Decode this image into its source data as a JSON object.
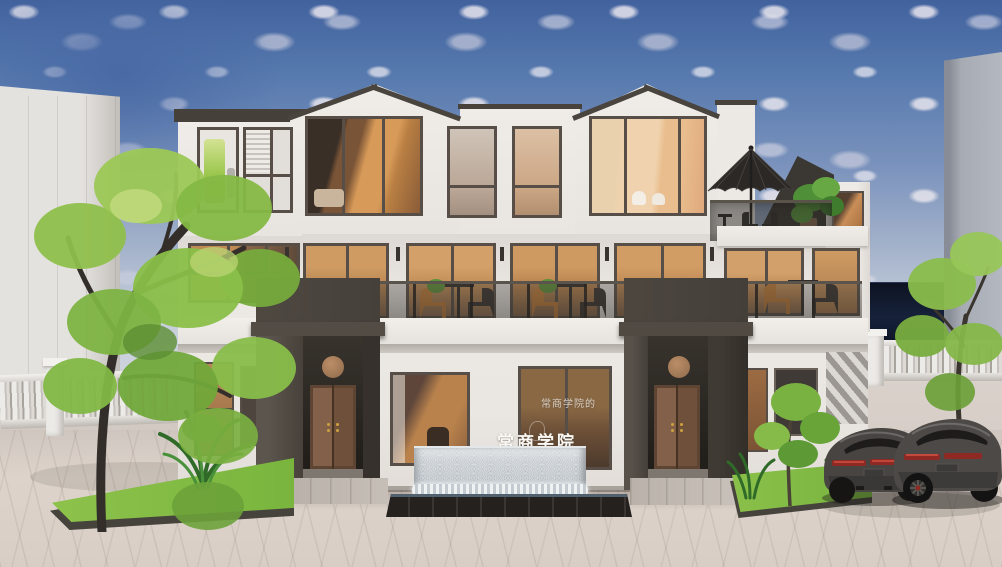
{
  "scene": {
    "description": "3D architectural rendering of a three-story white college building facade at daytime",
    "signage": {
      "main_wall_sign": "常商学院",
      "glass_door_text": "常商学院的"
    },
    "objects": [
      "white building with two gabled roof sections and warm-lit windows",
      "two dark charcoal entry porticos with brown wooden double doors",
      "round bronze medallion above each door",
      "second-floor cafe terrace with glass balustrade, tables and chairs",
      "rooftop patio umbrella and potted plants",
      "gray water-wall fountain with dark tile basin",
      "white baluster fences on both sides",
      "green planting beds with trees and shrubs",
      "two dark gray sports cars parked at right",
      "light background building at left",
      "gray background building at right",
      "blue sky with scattered clouds",
      "beige paved plaza foreground"
    ],
    "palette": {
      "sky_top": "#4a6aa5",
      "sky_horizon": "#c6cedb",
      "cloud": "#dcdbe4",
      "wall_white": "#ebe7e3",
      "frame_dark": "#564e47",
      "portico_dark": "#46413b",
      "door_brown": "#7d5a42",
      "medallion_bronze": "#a87d5b",
      "interior_warm": "#cf9b63",
      "grass_green": "#83bd44",
      "foliage_green": "#8fbf4b",
      "plaza_beige": "#d8cec6",
      "water_gray": "#b3bcc3",
      "basin_dark": "#24211e",
      "car_gray": "#474441",
      "taillight_red": "#8e2a23",
      "fence_white": "#ece9e6",
      "bg_building_left": "#e0deda",
      "bg_building_right": "#a6abb4",
      "dark_wall_navy": "#101828"
    }
  }
}
